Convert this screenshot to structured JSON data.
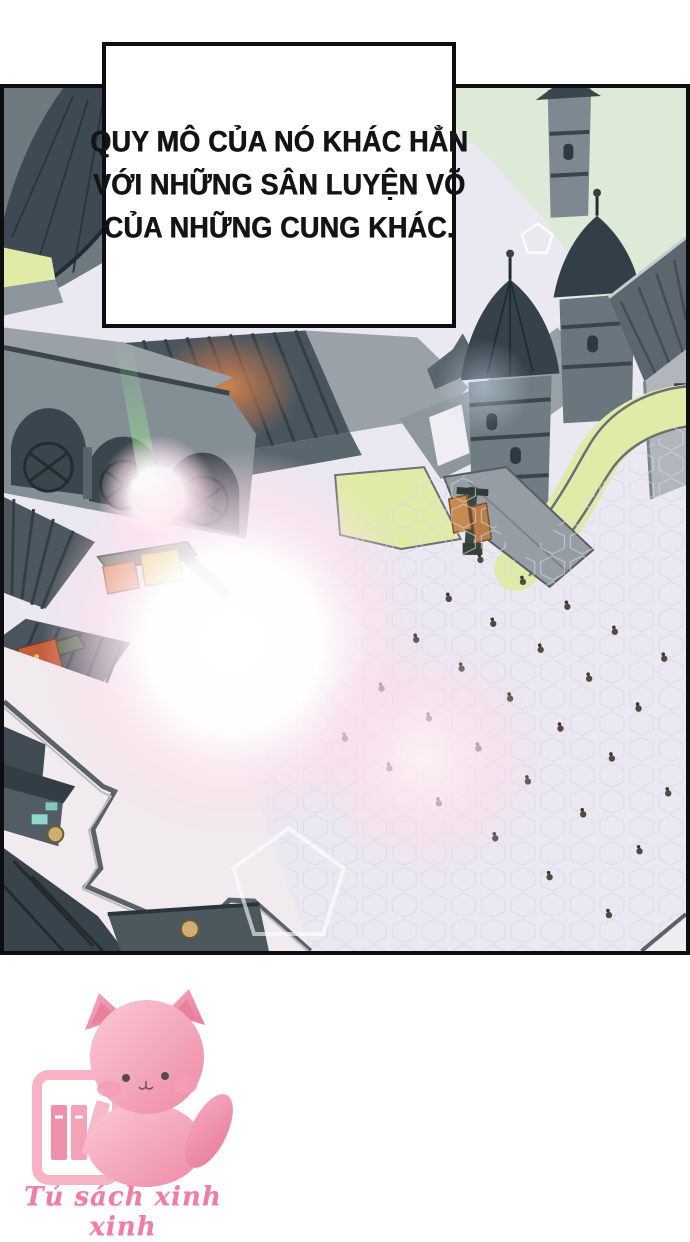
{
  "panel": {
    "narration": {
      "lines": [
        "QUY MÔ CỦA NÓ KHÁC HẲN",
        "VỚI NHỮNG SÂN LUYỆN VÕ",
        "CỦA NHỮNG CUNG KHÁC."
      ]
    },
    "scene": {
      "description": "aerial isometric view of a palace training courtyard with scattered trainees",
      "colors": {
        "sky": "#dcead7",
        "roof_dark": "#3e4a53",
        "roof_mid": "#55626b",
        "wall_gray": "#99a1a8",
        "wall_light": "#b3b9bf",
        "grass": "#e0eba8",
        "courtyard": "#eae8f1",
        "glow_orange": "#c87a4c",
        "flare_pink": "#ffd9e8",
        "banner_orange": "#c35f38",
        "banner_yellow": "#e3cf52"
      },
      "figures": [
        [
          482,
          473
        ],
        [
          525,
          495
        ],
        [
          450,
          512
        ],
        [
          570,
          520
        ],
        [
          495,
          537
        ],
        [
          618,
          545
        ],
        [
          417,
          553
        ],
        [
          543,
          563
        ],
        [
          668,
          572
        ],
        [
          463,
          582
        ],
        [
          592,
          592
        ],
        [
          382,
          602
        ],
        [
          512,
          612
        ],
        [
          642,
          622
        ],
        [
          430,
          632
        ],
        [
          563,
          642
        ],
        [
          345,
          652
        ],
        [
          480,
          662
        ],
        [
          615,
          672
        ],
        [
          390,
          682
        ],
        [
          530,
          695
        ],
        [
          672,
          707
        ],
        [
          440,
          717
        ],
        [
          586,
          728
        ],
        [
          497,
          752
        ],
        [
          643,
          765
        ],
        [
          552,
          791
        ],
        [
          612,
          829
        ]
      ]
    }
  },
  "footer": {
    "logo_text": "Tủ sách xinh xinh",
    "logo_color": "#ee7fa4"
  }
}
